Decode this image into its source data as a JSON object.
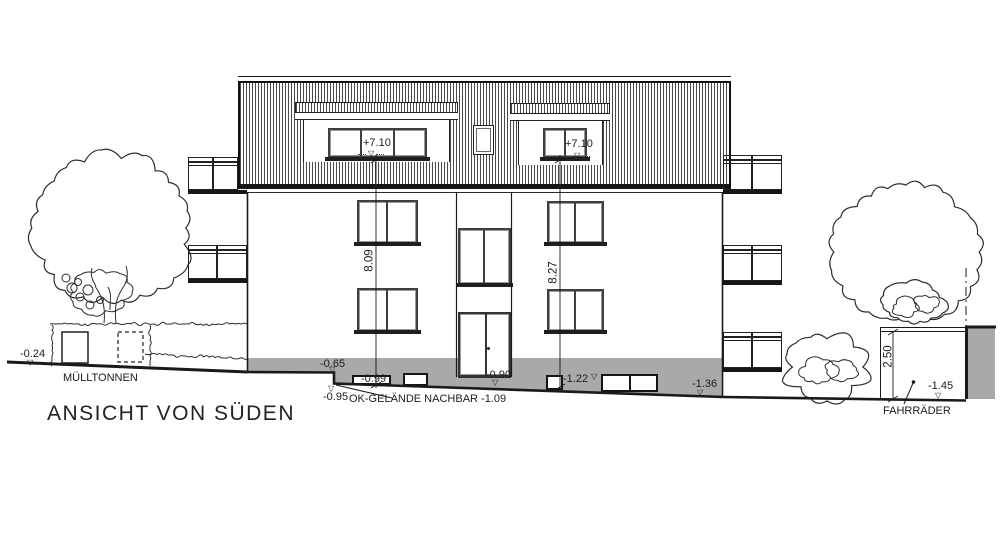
{
  "drawing": {
    "title": "ANSICHT VON SÜDEN",
    "site_labels": {
      "muelltonnen": "MÜLLTONNEN",
      "fahrraeder": "FAHRRÄDER",
      "ok_gelaende_nachbar": "OK-GELÄNDE NACHBAR  -1.09"
    },
    "elevation_marks": {
      "left_ground": "-0.24",
      "step_top": "-0.65",
      "step_bottom": "-0.95",
      "basement_window_left": "-0.99",
      "entrance_door": "-0.90",
      "basement_mid": "-1.22",
      "basement_right": "-1.36",
      "bike_pit": "-1.45",
      "dormer_left": "+7.10",
      "dormer_right": "+7.10"
    },
    "dimensions": {
      "facade_height_left": "8.09",
      "facade_height_right": "8.27",
      "pit_depth": "2.50"
    },
    "colors": {
      "line": "#1a1a1a",
      "plinth_gray": "#a9a9a9",
      "paper": "#ffffff"
    }
  },
  "icons": {
    "level_marker": "▽"
  }
}
